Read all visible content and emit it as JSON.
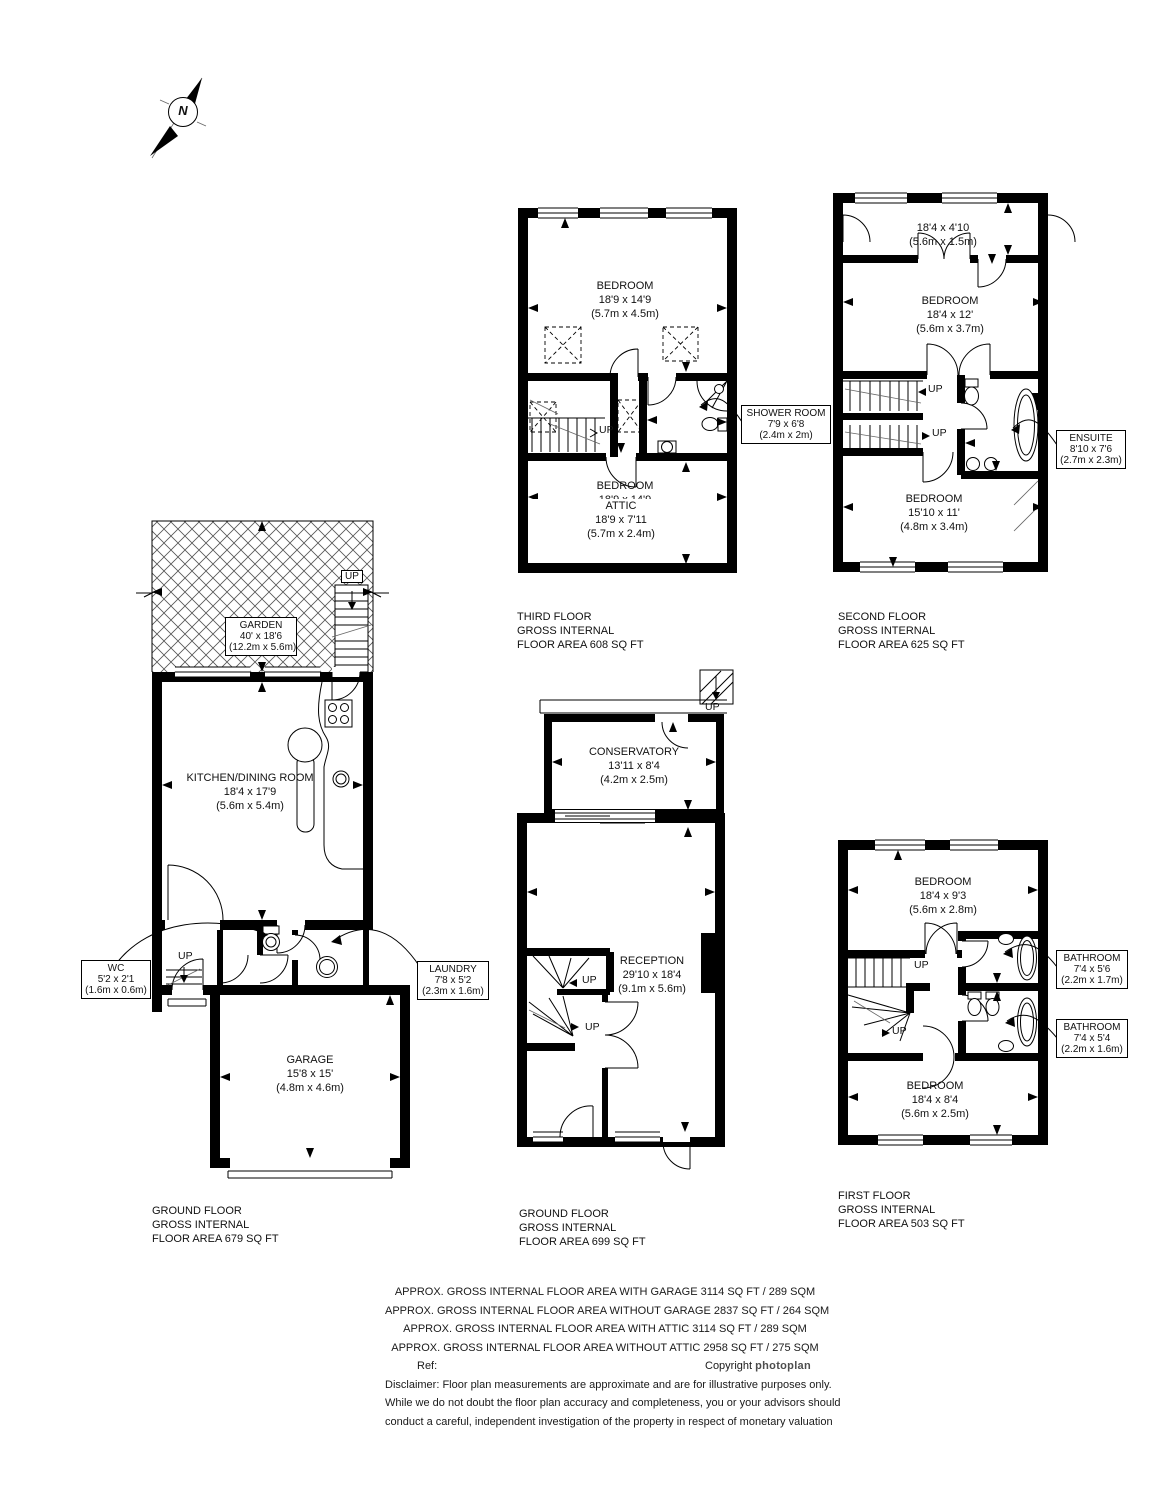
{
  "colors": {
    "wall": "#000000",
    "background": "#ffffff",
    "hatch": "#555555"
  },
  "compass": {
    "north": "N"
  },
  "floors": {
    "third": {
      "rooms": {
        "bedroom": {
          "name": "BEDROOM",
          "imp": "18'9 x 14'9",
          "met": "(5.7m x 4.5m)"
        },
        "attic": {
          "name": "ATTIC",
          "imp": "18'9 x 7'11",
          "met": "(5.7m x 2.4m)"
        },
        "shower": {
          "name": "SHOWER ROOM",
          "imp": "7'9 x 6'8",
          "met": "(2.4m x 2m)"
        }
      },
      "up": "UP",
      "label": {
        "l1": "THIRD FLOOR",
        "l2": "GROSS INTERNAL",
        "l3": "FLOOR AREA 608 SQ FT"
      }
    },
    "second": {
      "rooms": {
        "landing": {
          "imp": "18'4 x 4'10",
          "met": "(5.6m x 1.5m)"
        },
        "bedroom1": {
          "name": "BEDROOM",
          "imp": "18'4 x 12'",
          "met": "(5.6m x 3.7m)"
        },
        "bedroom2": {
          "name": "BEDROOM",
          "imp": "15'10 x 11'",
          "met": "(4.8m x 3.4m)"
        },
        "ensuite": {
          "name": "ENSUITE",
          "imp": "8'10 x 7'6",
          "met": "(2.7m x 2.3m)"
        }
      },
      "up": "UP",
      "label": {
        "l1": "SECOND FLOOR",
        "l2": "GROSS INTERNAL",
        "l3": "FLOOR AREA 625 SQ FT"
      }
    },
    "ground_left": {
      "rooms": {
        "garden": {
          "name": "GARDEN",
          "imp": "40' x 18'6",
          "met": "(12.2m x 5.6m)"
        },
        "kitchen": {
          "name": "KITCHEN/DINING ROOM",
          "imp": "18'4 x 17'9",
          "met": "(5.6m x 5.4m)"
        },
        "wc": {
          "name": "WC",
          "imp": "5'2 x 2'1",
          "met": "(1.6m x 0.6m)"
        },
        "laundry": {
          "name": "LAUNDRY",
          "imp": "7'8 x 5'2",
          "met": "(2.3m x 1.6m)"
        },
        "garage": {
          "name": "GARAGE",
          "imp": "15'8 x 15'",
          "met": "(4.8m x 4.6m)"
        }
      },
      "up": "UP",
      "label": {
        "l1": "GROUND FLOOR",
        "l2": "GROSS INTERNAL",
        "l3": "FLOOR AREA 679 SQ FT"
      }
    },
    "ground_mid": {
      "rooms": {
        "conservatory": {
          "name": "CONSERVATORY",
          "imp": "13'11 x 8'4",
          "met": "(4.2m x 2.5m)"
        },
        "reception": {
          "name": "RECEPTION",
          "imp": "29'10 x 18'4",
          "met": "(9.1m x 5.6m)"
        }
      },
      "up": "UP",
      "label": {
        "l1": "GROUND FLOOR",
        "l2": "GROSS INTERNAL",
        "l3": "FLOOR AREA 699 SQ FT"
      }
    },
    "first": {
      "rooms": {
        "bedroom1": {
          "name": "BEDROOM",
          "imp": "18'4 x 9'3",
          "met": "(5.6m x 2.8m)"
        },
        "bedroom2": {
          "name": "BEDROOM",
          "imp": "18'4 x 8'4",
          "met": "(5.6m x 2.5m)"
        },
        "bathroom1": {
          "name": "BATHROOM",
          "imp": "7'4 x 5'6",
          "met": "(2.2m x 1.7m)"
        },
        "bathroom2": {
          "name": "BATHROOM",
          "imp": "7'4 x 5'4",
          "met": "(2.2m x 1.6m)"
        }
      },
      "up": "UP",
      "label": {
        "l1": "FIRST FLOOR",
        "l2": "GROSS INTERNAL",
        "l3": "FLOOR AREA 503 SQ FT"
      }
    }
  },
  "summary": {
    "lines": [
      "APPROX. GROSS INTERNAL FLOOR AREA WITH GARAGE 3114 SQ FT / 289 SQM",
      "APPROX. GROSS INTERNAL FLOOR AREA WITHOUT GARAGE 2837 SQ FT / 264 SQM",
      "APPROX. GROSS INTERNAL FLOOR AREA WITH ATTIC 3114 SQ FT / 289 SQM",
      "APPROX. GROSS INTERNAL FLOOR AREA WITHOUT ATTIC 2958 SQ FT / 275 SQM"
    ],
    "ref_label": "Ref:",
    "copyright_label": "Copyright",
    "brand": "photoplan",
    "disclaimer": [
      "Disclaimer: Floor plan measurements are approximate and are for illustrative purposes only.",
      "While we do not doubt the floor plan accuracy and completeness, you or your advisors should",
      "conduct a careful, independent investigation of the property in respect of monetary valuation"
    ]
  }
}
